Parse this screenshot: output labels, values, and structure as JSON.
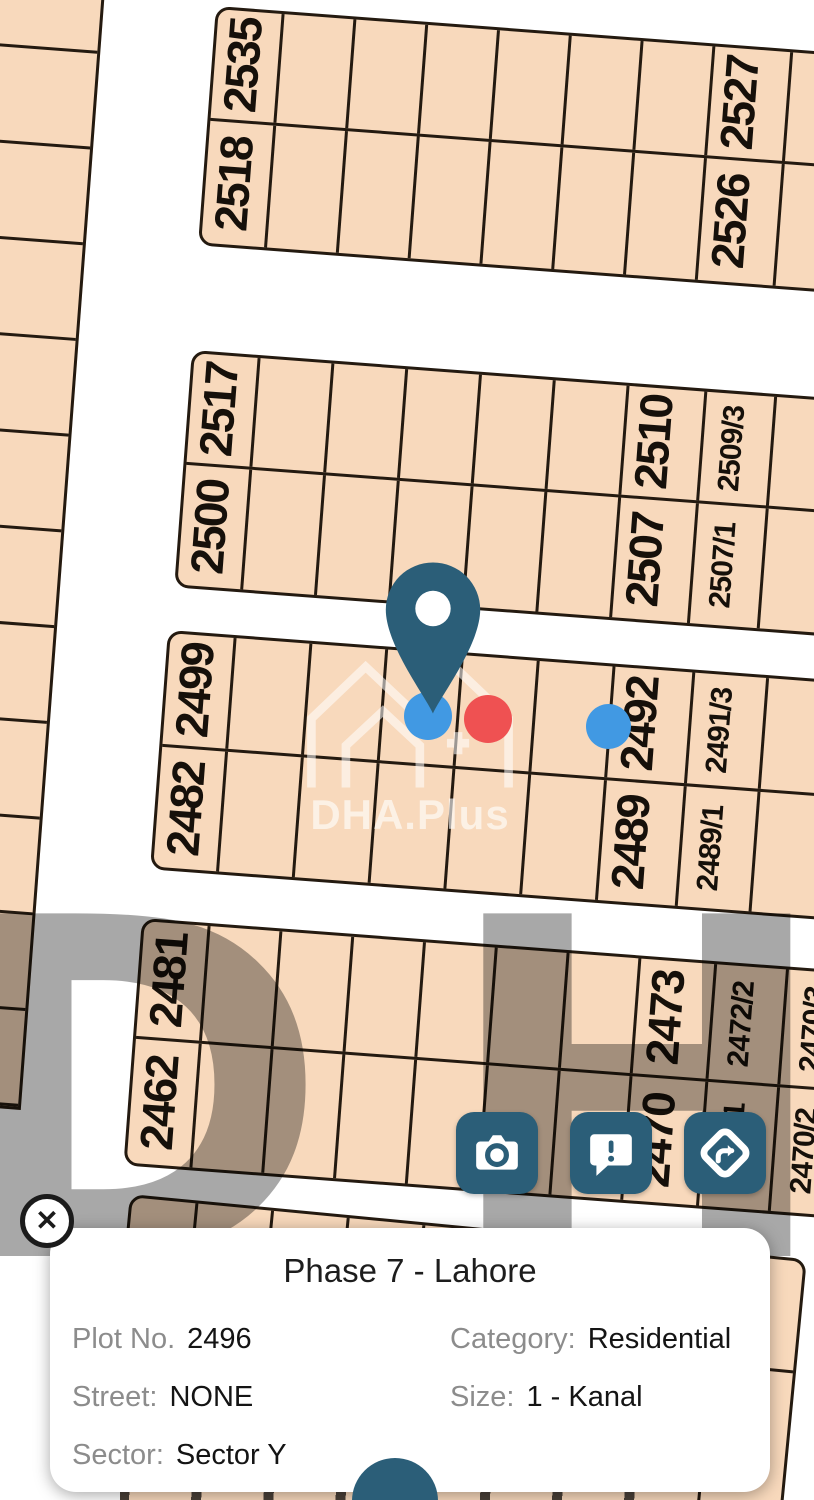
{
  "watermark": {
    "brand": "DHA.Plus",
    "letters": "DH"
  },
  "colors": {
    "plot_fill": "#f8d9bc",
    "plot_line": "#241a10",
    "teal": "#2b5e78",
    "marker_blue": "#4199e3",
    "marker_red": "#ef5152",
    "card_label": "#8c8c8c",
    "card_value": "#141414"
  },
  "map": {
    "left_strip": {
      "x": -42,
      "y": -56,
      "w": 150,
      "rot": 4.3,
      "cell_h": 96,
      "cells": 12
    },
    "blocks": [
      {
        "x": 216,
        "y": 6,
        "rot": 4.3,
        "rows": [
          112,
          122
        ],
        "cols": [
          {
            "w": 66,
            "top": "2535",
            "bottom": "2518"
          },
          {
            "w": 72
          },
          {
            "w": 72
          },
          {
            "w": 72
          },
          {
            "w": 72
          },
          {
            "w": 72
          },
          {
            "w": 72
          },
          {
            "w": 78,
            "top": "2527",
            "bottom": "2526"
          },
          {
            "w": 90
          }
        ]
      },
      {
        "x": 192,
        "y": 350,
        "rot": 4.3,
        "rows": [
          112,
          120
        ],
        "cols": [
          {
            "w": 66,
            "top": "2517",
            "bottom": "2500"
          },
          {
            "w": 74
          },
          {
            "w": 74
          },
          {
            "w": 74
          },
          {
            "w": 74
          },
          {
            "w": 74
          },
          {
            "w": 78,
            "top": "2510",
            "bottom": "2507"
          },
          {
            "w": 70,
            "top": "2509/3",
            "bottom": "2507/1"
          },
          {
            "w": 85
          }
        ]
      },
      {
        "x": 168,
        "y": 630,
        "rot": 4.3,
        "rows": [
          114,
          120
        ],
        "cols": [
          {
            "w": 66,
            "top": "2499",
            "bottom": "2482"
          },
          {
            "w": 76
          },
          {
            "w": 76
          },
          {
            "w": 76
          },
          {
            "w": 76
          },
          {
            "w": 76
          },
          {
            "w": 80,
            "top": "2492",
            "bottom": "2489"
          },
          {
            "w": 74,
            "top": "2491/3",
            "bottom": "2489/1"
          },
          {
            "w": 85
          }
        ]
      },
      {
        "x": 142,
        "y": 918,
        "rot": 4.3,
        "rows": [
          118,
          124
        ],
        "cols": [
          {
            "w": 66,
            "top": "2481",
            "bottom": "2462"
          },
          {
            "w": 72
          },
          {
            "w": 72
          },
          {
            "w": 72
          },
          {
            "w": 72
          },
          {
            "w": 72
          },
          {
            "w": 72
          },
          {
            "w": 76,
            "top": "2473",
            "bottom": "2470"
          },
          {
            "w": 72,
            "top": "2472/2",
            "bottom": "2470/1"
          },
          {
            "w": 80,
            "top": "2470/3",
            "bottom": "2470/2"
          }
        ]
      },
      {
        "x": 130,
        "y": 1194,
        "rot": 5.5,
        "rows": [
          112,
          160
        ],
        "cols": [
          {
            "w": 66,
            "top": "1"
          },
          {
            "w": 76
          },
          {
            "w": 76
          },
          {
            "w": 76
          },
          {
            "w": 76
          },
          {
            "w": 76
          },
          {
            "w": 76
          },
          {
            "w": 72,
            "top": "2452/1",
            "bottom": "2450/2"
          },
          {
            "w": 80
          }
        ]
      }
    ],
    "pin": {
      "x": 374,
      "y": 560
    },
    "dots": [
      {
        "x": 404,
        "y": 692,
        "d": 48,
        "color": "blue"
      },
      {
        "x": 464,
        "y": 695,
        "d": 48,
        "color": "red"
      },
      {
        "x": 586,
        "y": 704,
        "d": 45,
        "color": "blue"
      }
    ]
  },
  "buttons": [
    {
      "name": "camera",
      "icon": "camera-icon"
    },
    {
      "name": "feedback",
      "icon": "feedback-icon"
    },
    {
      "name": "directions",
      "icon": "directions-icon"
    }
  ],
  "card": {
    "title": "Phase 7 - Lahore",
    "close_icon": "✕",
    "fields": [
      {
        "label": "Plot No.",
        "value": "2496"
      },
      {
        "label": "Category:",
        "value": "Residential"
      },
      {
        "label": "Street:",
        "value": "NONE"
      },
      {
        "label": "Size:",
        "value": "1 - Kanal"
      },
      {
        "label": "Sector:",
        "value": "Sector Y"
      }
    ]
  }
}
